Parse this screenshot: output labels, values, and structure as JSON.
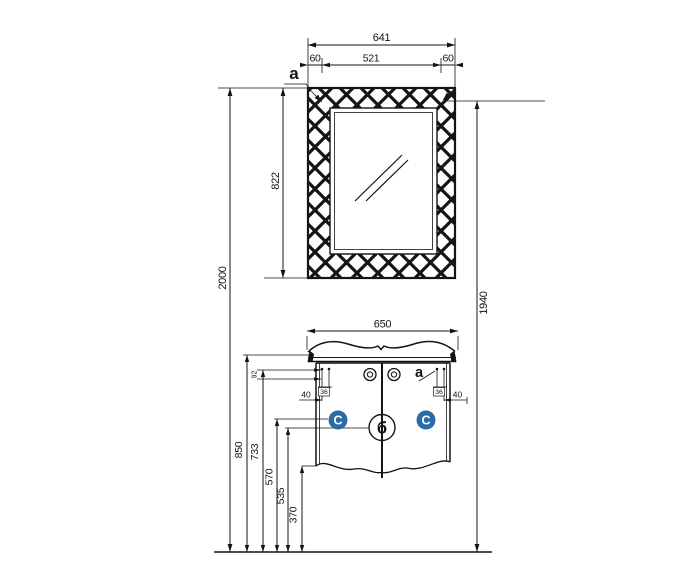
{
  "figure": {
    "type": "technical installation drawing",
    "subject": "bathroom mirror with lattice frame and vanity washbasin cabinet, front elevation with dimensions"
  },
  "dimensions": {
    "mirror_total_width": "641",
    "mirror_frame_left": "60",
    "mirror_glass_width": "521",
    "mirror_frame_right": "60",
    "mirror_height": "822",
    "total_height": "2000",
    "mirror_mount_height": "1940",
    "cabinet_width": "650",
    "worktop_height": "850",
    "handle_line_height": "733",
    "door_marker_height": "570",
    "center_joint_height": "535",
    "cabinet_bottom_height": "370",
    "drill_offset_92": "92",
    "drill_offset_36_left": "36",
    "drill_offset_36_right": "36",
    "drill_offset_40_left": "40",
    "drill_offset_40_right": "40"
  },
  "markers": {
    "mirror_section": "a",
    "cabinet_section": "a",
    "left_door": "C",
    "right_door": "C",
    "center_joint": "б"
  },
  "colors": {
    "line": "#141414",
    "accent": "#2b6ca8"
  }
}
